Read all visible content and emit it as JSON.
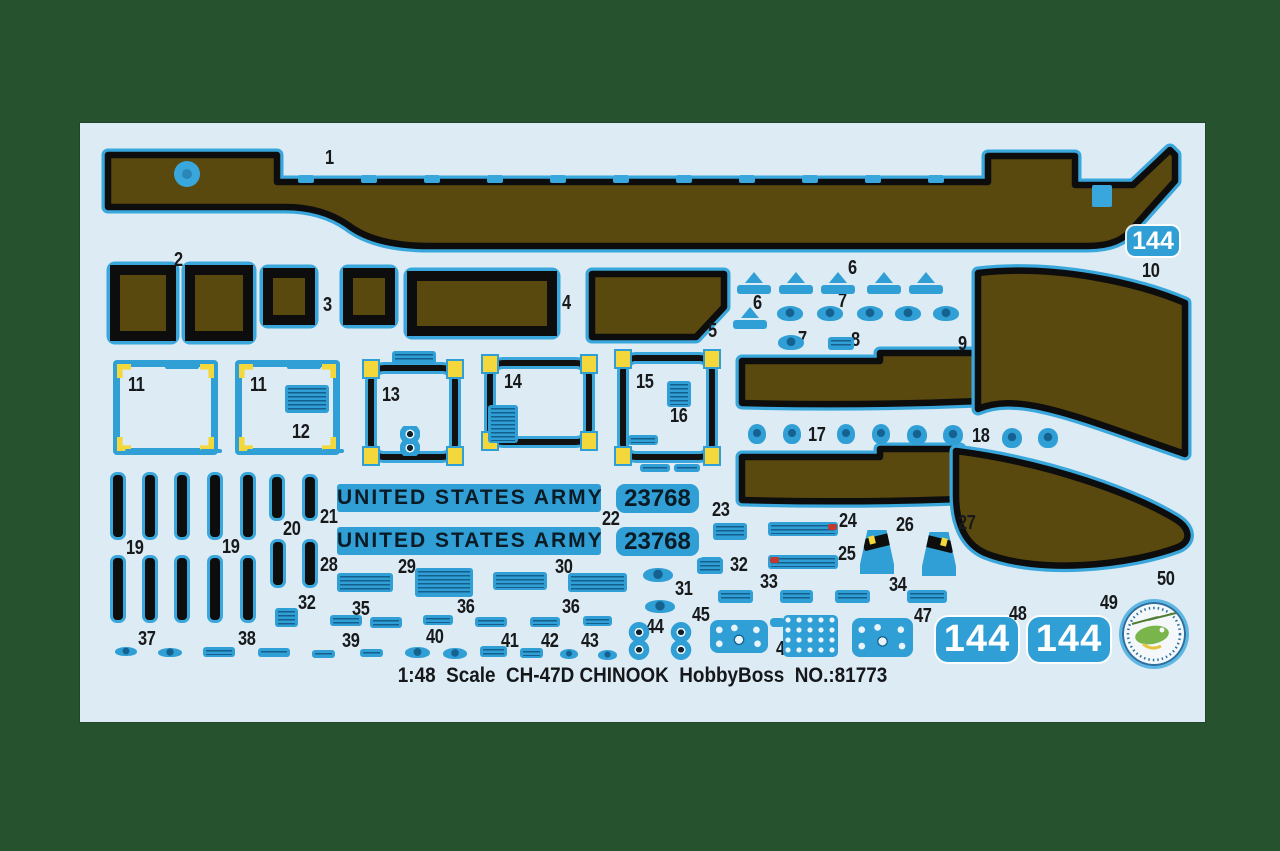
{
  "scene": {
    "background_color": "#26522e",
    "sheet_color": "#dcebf4"
  },
  "colors": {
    "decal_blue": "#2f9fd6",
    "decal_dark_text": "#0d4a73",
    "walkway_brown": "#5a490f",
    "outline_black": "#0d0d0d",
    "corner_yellow": "#f4d73a",
    "accent_red": "#c13a30",
    "badge_green": "#79b54a",
    "numeral_white": "#ffffff"
  },
  "texts": {
    "army": "UNITED STATES ARMY",
    "serial": "23768",
    "rotor_number": "144",
    "caption": "1:48  Scale  CH-47D CHINOOK  HobbyBoss  NO.:81773"
  },
  "part_labels": [
    [
      "1",
      245,
      25
    ],
    [
      "2",
      94,
      127
    ],
    [
      "3",
      243,
      172
    ],
    [
      "4",
      482,
      170
    ],
    [
      "5",
      628,
      198
    ],
    [
      "6",
      768,
      135
    ],
    [
      "6",
      673,
      170
    ],
    [
      "7",
      758,
      168
    ],
    [
      "7",
      718,
      206
    ],
    [
      "8",
      771,
      207
    ],
    [
      "9",
      878,
      211
    ],
    [
      "10",
      1062,
      138
    ],
    [
      "11",
      48,
      252
    ],
    [
      "11",
      170,
      252
    ],
    [
      "12",
      212,
      299
    ],
    [
      "13",
      302,
      262
    ],
    [
      "14",
      424,
      249
    ],
    [
      "15",
      556,
      249
    ],
    [
      "16",
      590,
      283
    ],
    [
      "17",
      728,
      302
    ],
    [
      "18",
      892,
      303
    ],
    [
      "19",
      46,
      415
    ],
    [
      "19",
      142,
      414
    ],
    [
      "20",
      203,
      396
    ],
    [
      "21",
      240,
      384
    ],
    [
      "22",
      522,
      386
    ],
    [
      "23",
      632,
      377
    ],
    [
      "24",
      759,
      388
    ],
    [
      "25",
      758,
      421
    ],
    [
      "26",
      816,
      392
    ],
    [
      "27",
      878,
      390
    ],
    [
      "28",
      240,
      432
    ],
    [
      "29",
      318,
      434
    ],
    [
      "30",
      475,
      434
    ],
    [
      "31",
      595,
      456
    ],
    [
      "32",
      218,
      470
    ],
    [
      "32",
      650,
      432
    ],
    [
      "33",
      680,
      449
    ],
    [
      "34",
      809,
      452
    ],
    [
      "35",
      272,
      476
    ],
    [
      "36",
      377,
      474
    ],
    [
      "36",
      482,
      474
    ],
    [
      "37",
      58,
      506
    ],
    [
      "38",
      158,
      506
    ],
    [
      "39",
      262,
      508
    ],
    [
      "40",
      346,
      504
    ],
    [
      "41",
      421,
      508
    ],
    [
      "42",
      461,
      508
    ],
    [
      "43",
      501,
      508
    ],
    [
      "44",
      566,
      494
    ],
    [
      "45",
      612,
      482
    ],
    [
      "46",
      696,
      516
    ],
    [
      "47",
      834,
      483
    ],
    [
      "48",
      929,
      481
    ],
    [
      "49",
      1020,
      470
    ],
    [
      "50",
      1077,
      446
    ]
  ],
  "decal_marks": [
    [
      "bar",
      33,
      352,
      10,
      62
    ],
    [
      "bar",
      65,
      352,
      10,
      62
    ],
    [
      "bar",
      97,
      352,
      10,
      62
    ],
    [
      "bar",
      130,
      352,
      10,
      62
    ],
    [
      "bar",
      163,
      352,
      10,
      62
    ],
    [
      "bar",
      33,
      435,
      10,
      62
    ],
    [
      "bar",
      65,
      435,
      10,
      62
    ],
    [
      "bar",
      97,
      435,
      10,
      62
    ],
    [
      "bar",
      130,
      435,
      10,
      62
    ],
    [
      "bar",
      163,
      435,
      10,
      62
    ],
    [
      "bar",
      192,
      354,
      10,
      41
    ],
    [
      "bar",
      225,
      354,
      10,
      41
    ],
    [
      "bar",
      193,
      419,
      10,
      43
    ],
    [
      "bar",
      225,
      419,
      10,
      43
    ],
    [
      "arrow",
      657,
      149,
      34,
      22
    ],
    [
      "arrow",
      699,
      149,
      34,
      22
    ],
    [
      "arrow",
      741,
      149,
      34,
      22
    ],
    [
      "arrow",
      787,
      149,
      34,
      22
    ],
    [
      "arrow",
      829,
      149,
      34,
      22
    ],
    [
      "arrow",
      653,
      184,
      34,
      22
    ],
    [
      "blob",
      697,
      183,
      26,
      15
    ],
    [
      "blob",
      737,
      183,
      26,
      15
    ],
    [
      "blob",
      777,
      183,
      26,
      15
    ],
    [
      "blob",
      815,
      183,
      26,
      15
    ],
    [
      "blob",
      853,
      183,
      26,
      15
    ],
    [
      "blob",
      698,
      212,
      26,
      15
    ],
    [
      "stencil",
      748,
      214,
      26,
      13
    ],
    [
      "blob",
      668,
      301,
      18,
      20
    ],
    [
      "blob",
      703,
      301,
      18,
      20
    ],
    [
      "blob",
      757,
      301,
      18,
      20
    ],
    [
      "blob",
      792,
      301,
      18,
      20
    ],
    [
      "blob",
      827,
      302,
      20,
      20
    ],
    [
      "blob",
      863,
      302,
      20,
      20
    ],
    [
      "blob",
      922,
      305,
      20,
      20
    ],
    [
      "blob",
      958,
      305,
      20,
      20
    ],
    [
      "stencil",
      312,
      228,
      44,
      13
    ],
    [
      "fig8",
      320,
      303,
      20,
      30
    ],
    [
      "stencil",
      205,
      262,
      44,
      28
    ],
    [
      "stencil",
      408,
      282,
      30,
      38
    ],
    [
      "stencil",
      587,
      258,
      24,
      26
    ],
    [
      "stencil",
      548,
      312,
      30,
      10
    ],
    [
      "stencil",
      560,
      341,
      30,
      8
    ],
    [
      "stencil",
      594,
      341,
      26,
      8
    ],
    [
      "mark",
      85,
      241,
      34,
      5
    ],
    [
      "mark",
      45,
      326,
      28,
      4
    ],
    [
      "mark",
      95,
      326,
      10,
      4
    ],
    [
      "mark",
      120,
      326,
      22,
      4
    ],
    [
      "mark",
      207,
      241,
      34,
      5
    ],
    [
      "mark",
      167,
      326,
      28,
      4
    ],
    [
      "mark",
      217,
      326,
      10,
      4
    ],
    [
      "mark",
      242,
      326,
      22,
      4
    ],
    [
      "stencil",
      633,
      400,
      34,
      17
    ],
    [
      "stencil",
      620,
      434,
      22,
      15
    ],
    [
      "stencil",
      688,
      399,
      70,
      14
    ],
    [
      "red",
      748,
      401,
      9,
      6
    ],
    [
      "stencil",
      688,
      432,
      70,
      14
    ],
    [
      "red",
      690,
      434,
      9,
      6
    ],
    [
      "trapL",
      780,
      407,
      34,
      44
    ],
    [
      "trapR",
      842,
      409,
      34,
      44
    ],
    [
      "stencil",
      617,
      435,
      26,
      16
    ],
    [
      "stencil",
      638,
      467,
      35,
      13
    ],
    [
      "stencil",
      700,
      467,
      33,
      13
    ],
    [
      "stencil",
      755,
      467,
      35,
      13
    ],
    [
      "stencil",
      827,
      467,
      40,
      13
    ],
    [
      "stencil",
      257,
      450,
      56,
      19
    ],
    [
      "stencil",
      335,
      445,
      58,
      29
    ],
    [
      "stencil",
      413,
      449,
      54,
      18
    ],
    [
      "stencil",
      488,
      450,
      59,
      19
    ],
    [
      "blob",
      563,
      445,
      30,
      14
    ],
    [
      "blob",
      565,
      477,
      30,
      13
    ],
    [
      "stencil",
      195,
      485,
      23,
      19
    ],
    [
      "stencil",
      250,
      492,
      32,
      11
    ],
    [
      "stencil",
      290,
      494,
      32,
      11
    ],
    [
      "stencil",
      343,
      492,
      30,
      10
    ],
    [
      "stencil",
      395,
      494,
      32,
      10
    ],
    [
      "stencil",
      450,
      494,
      30,
      10
    ],
    [
      "stencil",
      503,
      493,
      29,
      10
    ],
    [
      "blob",
      35,
      524,
      22,
      9
    ],
    [
      "blob",
      78,
      525,
      24,
      9
    ],
    [
      "stencil",
      123,
      524,
      32,
      10
    ],
    [
      "stencil",
      178,
      525,
      32,
      9
    ],
    [
      "stencil",
      232,
      527,
      23,
      8
    ],
    [
      "stencil",
      280,
      526,
      23,
      8
    ],
    [
      "blob",
      325,
      524,
      25,
      11
    ],
    [
      "blob",
      363,
      525,
      24,
      11
    ],
    [
      "stencil",
      400,
      523,
      27,
      11
    ],
    [
      "stencil",
      440,
      525,
      23,
      10
    ],
    [
      "blob",
      480,
      526,
      18,
      10
    ],
    [
      "blob",
      518,
      527,
      19,
      10
    ],
    [
      "fig8",
      545,
      499,
      28,
      38
    ],
    [
      "fig8",
      587,
      499,
      28,
      38
    ],
    [
      "panel",
      630,
      497,
      58,
      33
    ],
    [
      "grid",
      703,
      492,
      55,
      42
    ],
    [
      "panel",
      772,
      495,
      61,
      39
    ]
  ]
}
